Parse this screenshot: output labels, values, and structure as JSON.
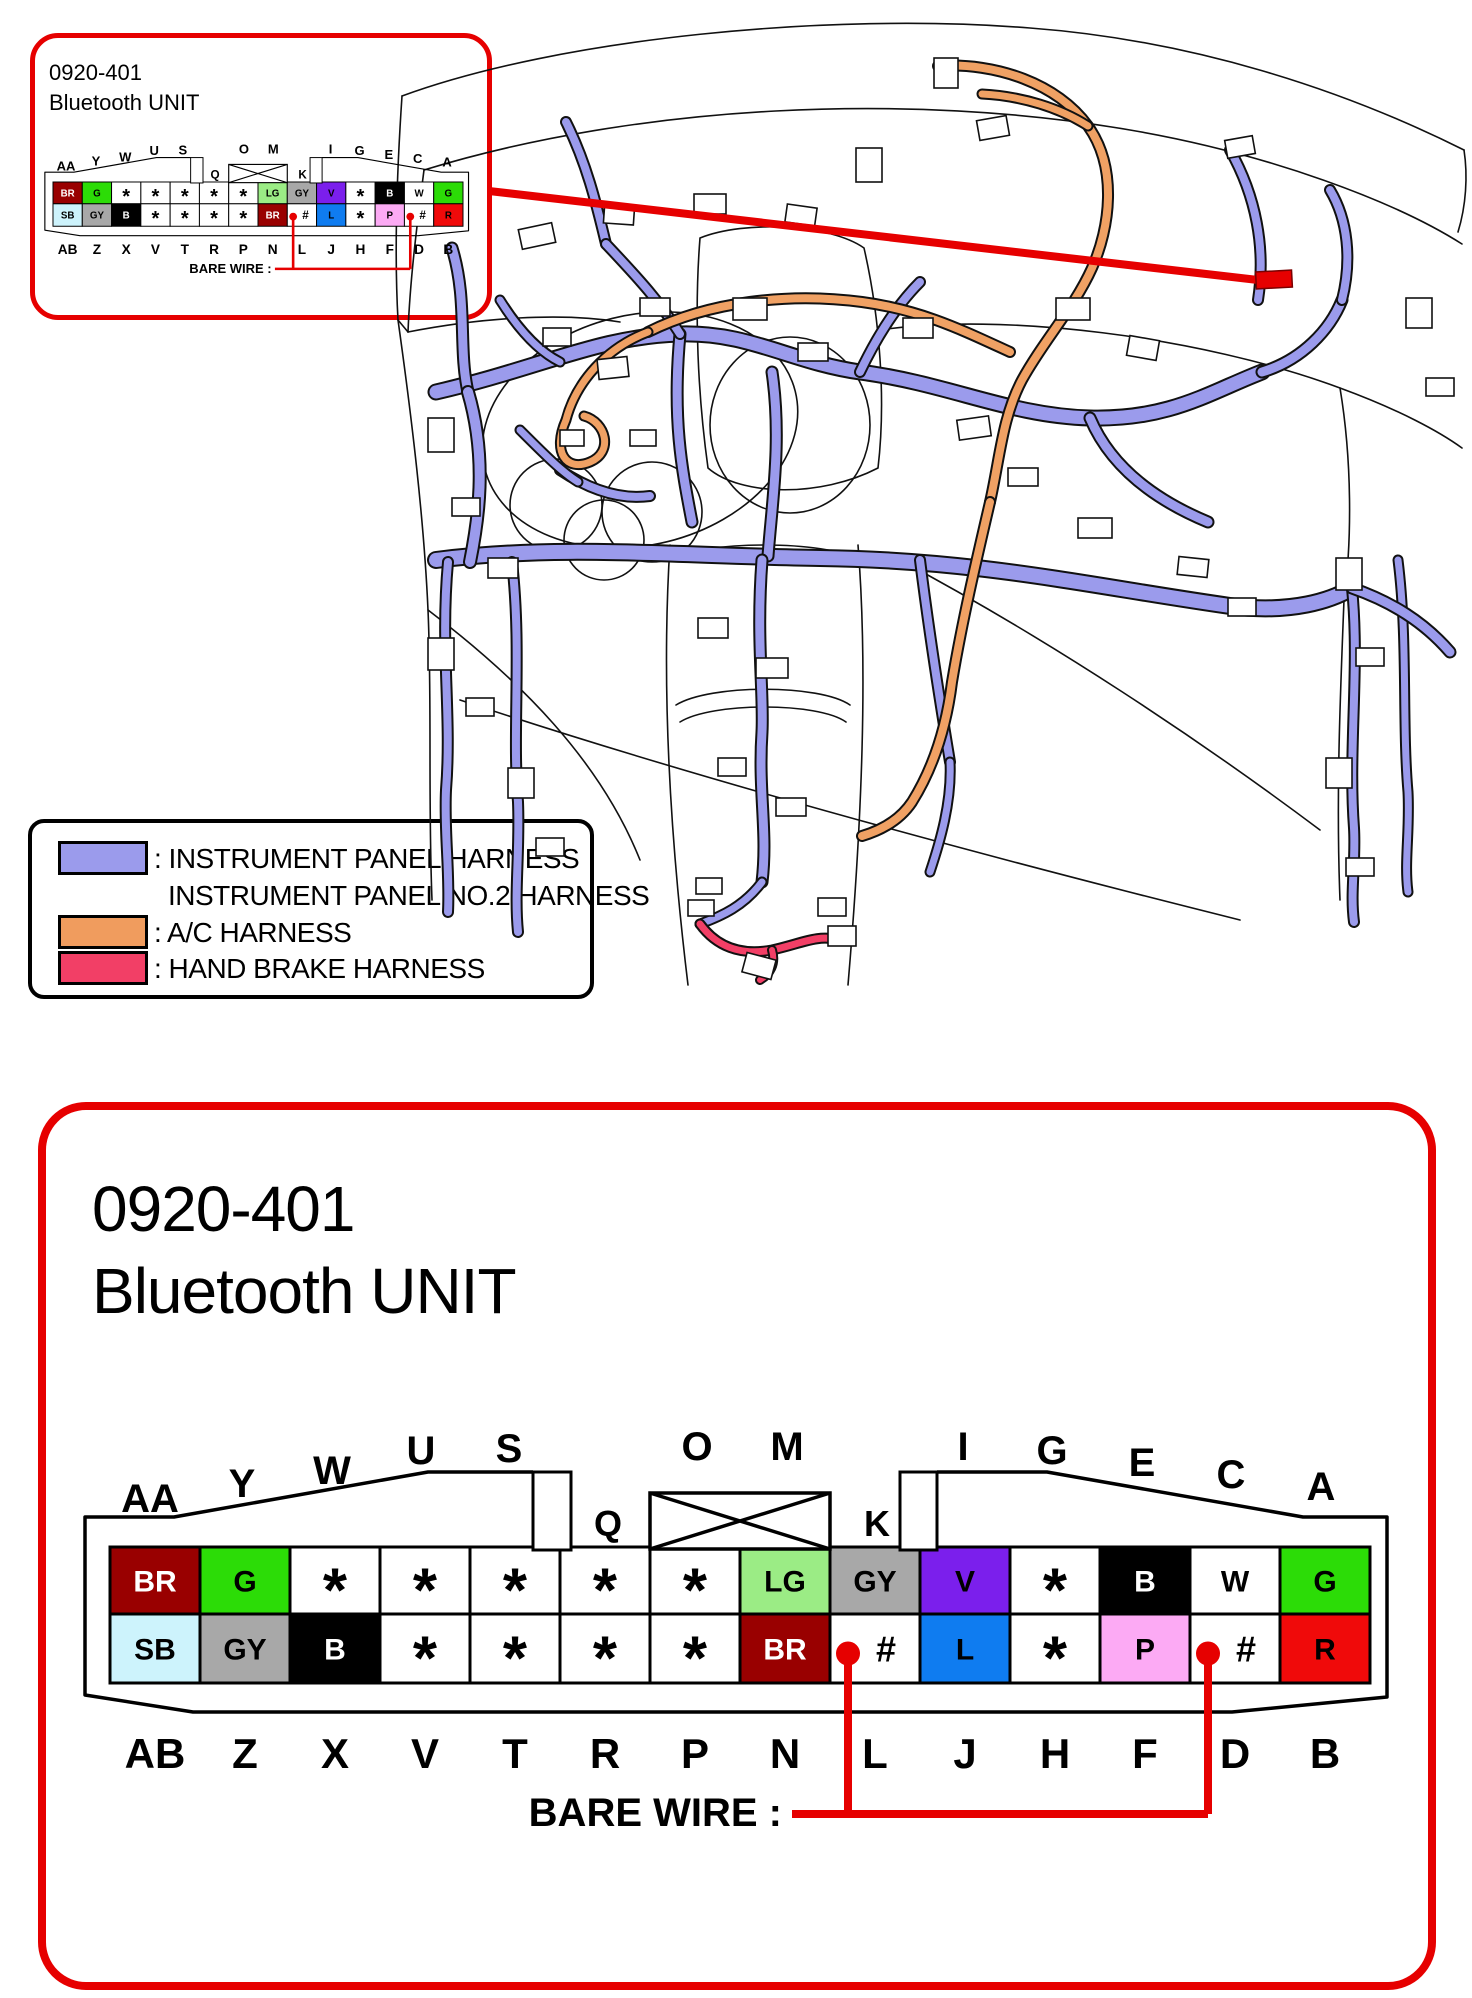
{
  "callout": {
    "code": "0920-401",
    "name": "Bluetooth UNIT"
  },
  "panel": {
    "code": "0920-401",
    "name": "Bluetooth UNIT"
  },
  "legend": {
    "items": [
      {
        "label": ": INSTRUMENT PANEL HARNESS",
        "label2": "INSTRUMENT PANEL NO.2 HARNESS",
        "color": "#9b9bec"
      },
      {
        "label": ": A/C HARNESS",
        "label2": "",
        "color": "#f09c5e"
      },
      {
        "label": ": HAND BRAKE HARNESS",
        "label2": "",
        "color": "#f23f66"
      }
    ]
  },
  "connector": {
    "bare_wire_label": "BARE WIRE :",
    "top_labels": [
      "AA",
      "Y",
      "W",
      "U",
      "S",
      "Q",
      "O",
      "M",
      "K",
      "I",
      "G",
      "E",
      "C",
      "A"
    ],
    "bottom_labels": [
      "AB",
      "Z",
      "X",
      "V",
      "T",
      "R",
      "P",
      "N",
      "L",
      "J",
      "H",
      "F",
      "D",
      "B"
    ],
    "row1": [
      {
        "label": "BR",
        "bg": "#990000",
        "fg": "#ffffff"
      },
      {
        "label": "G",
        "bg": "#2cdc07",
        "fg": "#000000"
      },
      {
        "label": "*"
      },
      {
        "label": "*"
      },
      {
        "label": "*"
      },
      {
        "label": "*"
      },
      {
        "label": "*"
      },
      {
        "label": "LG",
        "bg": "#9bec85",
        "fg": "#000000"
      },
      {
        "label": "GY",
        "bg": "#a8a8a8",
        "fg": "#000000"
      },
      {
        "label": "V",
        "bg": "#7b1fec",
        "fg": "#000000"
      },
      {
        "label": "*"
      },
      {
        "label": "B",
        "bg": "#000000",
        "fg": "#ffffff"
      },
      {
        "label": "W",
        "bg": "#ffffff",
        "fg": "#000000"
      },
      {
        "label": "G",
        "bg": "#2cdc07",
        "fg": "#000000"
      }
    ],
    "row2": [
      {
        "label": "SB",
        "bg": "#cdf3fc",
        "fg": "#000000"
      },
      {
        "label": "GY",
        "bg": "#a8a8a8",
        "fg": "#000000"
      },
      {
        "label": "B",
        "bg": "#000000",
        "fg": "#ffffff"
      },
      {
        "label": "*"
      },
      {
        "label": "*"
      },
      {
        "label": "*"
      },
      {
        "label": "*"
      },
      {
        "label": "BR",
        "bg": "#990000",
        "fg": "#ffffff"
      },
      {
        "label": "#",
        "bg": "#ffffff",
        "fg": "#000000",
        "bare": true
      },
      {
        "label": "L",
        "bg": "#0f7cf0",
        "fg": "#000000"
      },
      {
        "label": "*"
      },
      {
        "label": "P",
        "bg": "#fcaaf4",
        "fg": "#000000"
      },
      {
        "label": "#",
        "bg": "#ffffff",
        "fg": "#000000",
        "bare": true
      },
      {
        "label": "R",
        "bg": "#f00a0a",
        "fg": "#000000"
      }
    ]
  },
  "colors": {
    "highlight": "#e60000",
    "instrument_panel_harness": "#9b9bec",
    "ac_harness": "#f0a164",
    "hand_brake_harness": "#f23f66",
    "line_art": "#111111"
  }
}
